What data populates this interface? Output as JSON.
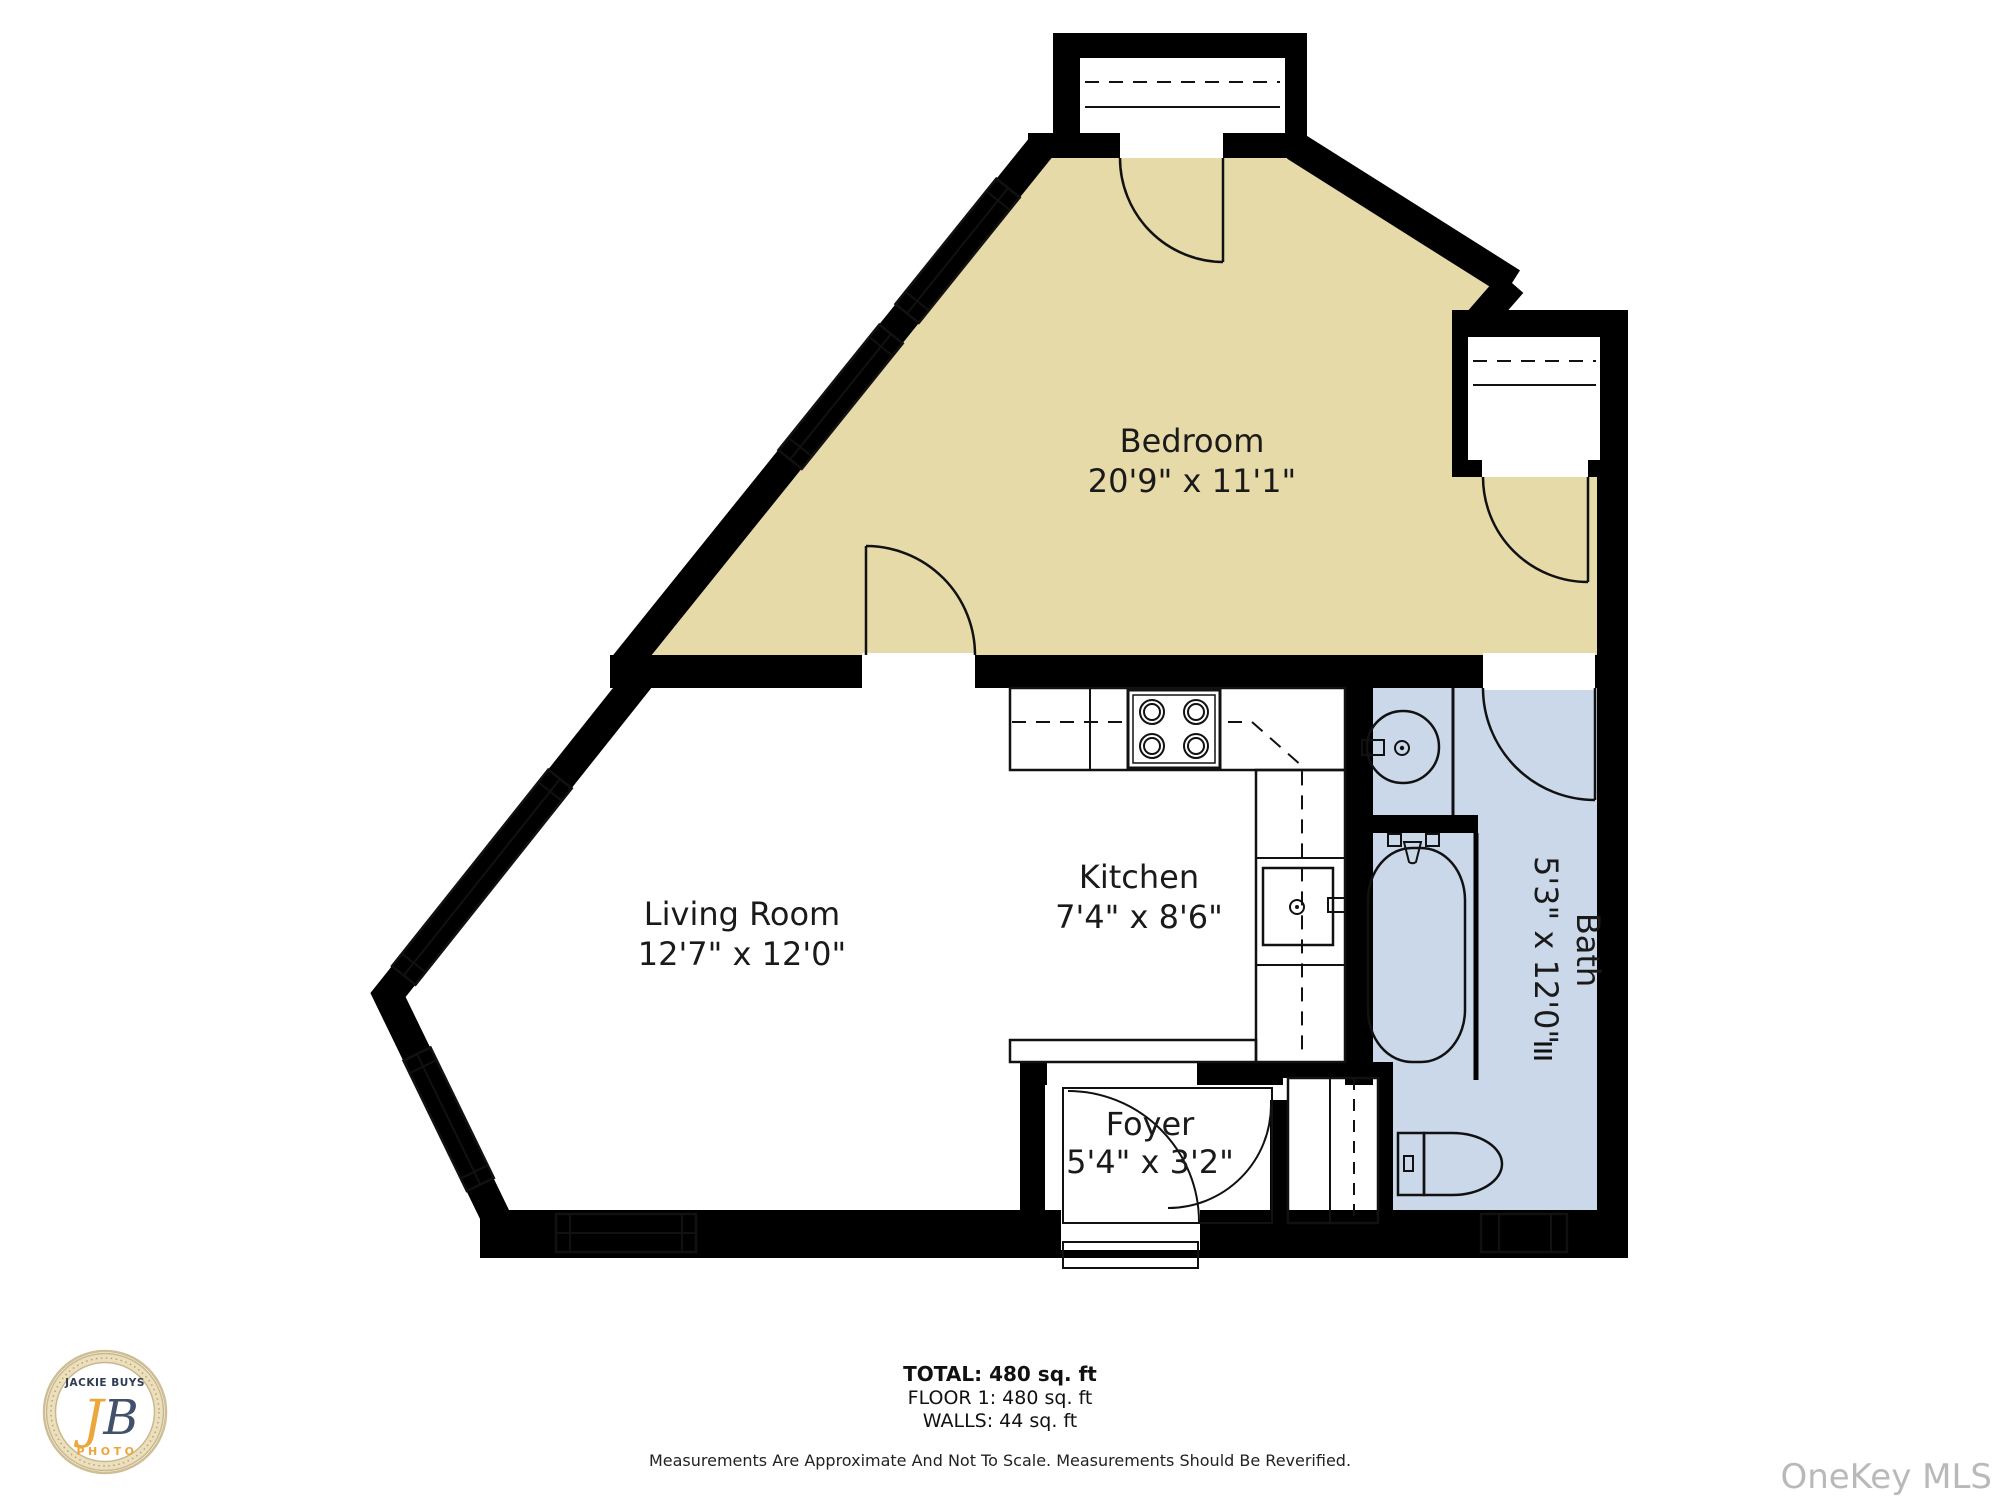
{
  "plan": {
    "rooms": {
      "bedroom": {
        "name": "Bedroom",
        "dims": "20'9\" x 11'1\""
      },
      "living": {
        "name": "Living Room",
        "dims": "12'7\" x 12'0\""
      },
      "kitchen": {
        "name": "Kitchen",
        "dims": "7'4\" x 8'6\""
      },
      "foyer": {
        "name": "Foyer",
        "dims": "5'4\" x 3'2\""
      },
      "bath": {
        "name": "Bath",
        "dims": "5'3\" x 12'0\""
      }
    },
    "colors": {
      "bedroom_floor": "#e6daa8",
      "bath_floor": "#cad8e9",
      "wall": "#000000"
    },
    "summary": {
      "total": "TOTAL: 480 sq. ft",
      "floor": "FLOOR 1: 480 sq. ft",
      "walls": "WALLS: 44 sq. ft"
    },
    "disclaimer": "Measurements Are Approximate And Not To Scale. Measurements Should Be Reverified."
  },
  "branding": {
    "logo": {
      "top": "JACKIE BUYS",
      "monogram_j": "J",
      "monogram_b": "B",
      "bottom": "PHOTO"
    },
    "watermark": "OneKey MLS"
  }
}
